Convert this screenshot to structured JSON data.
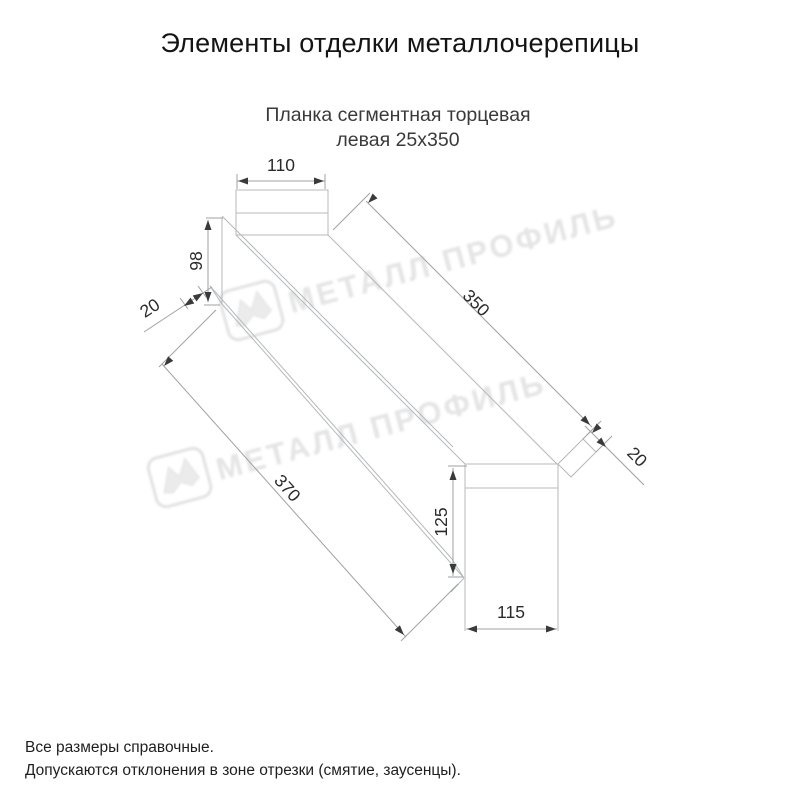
{
  "title": "Элементы отделки металлочерепицы",
  "subtitle_line1": "Планка сегментная торцевая",
  "subtitle_line2": "левая 25х350",
  "dimensions": {
    "top_width": "110",
    "left_height": "98",
    "hem_left": "20",
    "bottom_length": "370",
    "top_length": "350",
    "hem_right": "20",
    "end_height": "125",
    "end_width": "115"
  },
  "watermark": {
    "text": "МЕТАЛЛ ПРОФИЛЬ",
    "logo": "metall-profil-logo-icon"
  },
  "footer_line1": "Все размеры справочные.",
  "footer_line2": "Допускаются отклонения в зоне отрезки (смятие, заусенцы).",
  "colors": {
    "background": "#ffffff",
    "shape_line": "#b5b9bc",
    "dimension_line": "#9da2a5",
    "arrow": "#3a3a3a",
    "text": "#2b2b2b",
    "watermark": "#e2e2e2"
  }
}
